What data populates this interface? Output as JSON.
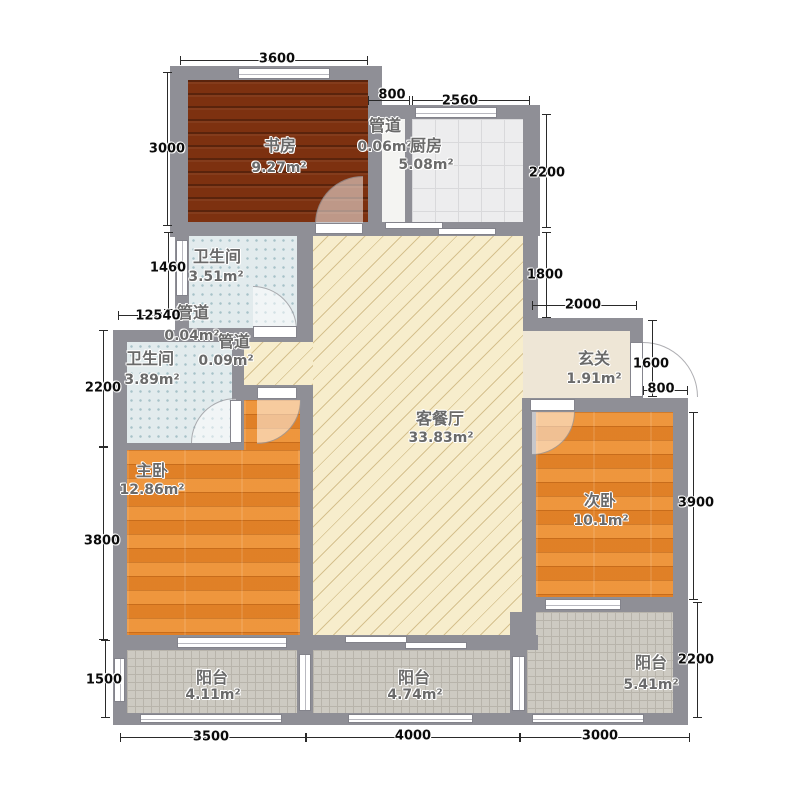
{
  "title": "apartment-floor-plan",
  "rooms": [
    {
      "id": "study",
      "label": "书房",
      "area": "9.27m²"
    },
    {
      "id": "duct-top",
      "label": "管道",
      "area": "0.06m²"
    },
    {
      "id": "kitchen",
      "label": "厨房",
      "area": "5.08m²"
    },
    {
      "id": "bath-upper",
      "label": "卫生间",
      "area": "3.51m²"
    },
    {
      "id": "duct-mid",
      "label": "管道",
      "area": "0.04m²"
    },
    {
      "id": "duct-lower",
      "label": "管道",
      "area": "0.09m²"
    },
    {
      "id": "bath-lower",
      "label": "卫生间",
      "area": "3.89m²"
    },
    {
      "id": "living-dining",
      "label": "客餐厅",
      "area": "33.83m²"
    },
    {
      "id": "foyer",
      "label": "玄关",
      "area": "1.91m²"
    },
    {
      "id": "master-bedroom",
      "label": "主卧",
      "area": "12.86m²"
    },
    {
      "id": "second-bedroom",
      "label": "次卧",
      "area": "10.1m²"
    },
    {
      "id": "balcony-left",
      "label": "阳台",
      "area": "4.11m²"
    },
    {
      "id": "balcony-middle",
      "label": "阳台",
      "area": "4.74m²"
    },
    {
      "id": "balcony-right",
      "label": "阳台",
      "area": "5.41m²"
    }
  ],
  "dims": {
    "top": [
      "3600",
      "800",
      "2560"
    ],
    "left": [
      "3000",
      "1460",
      "120",
      "540",
      "2200",
      "3800",
      "1500"
    ],
    "right": [
      "2200",
      "1800",
      "2000",
      "1600",
      "800",
      "3900",
      "2200"
    ],
    "bottom": [
      "3500",
      "4000",
      "3000"
    ]
  },
  "colors": {
    "wall": "#8f8f96",
    "study_floor": "#7d3110",
    "bedroom_floor": "#e8892d",
    "living_floor": "#f7edcc",
    "bath_floor": "#e2ebed",
    "kitchen_floor": "#ededee",
    "balcony_floor": "#cdcac2",
    "foyer_floor": "#eee6d6"
  }
}
